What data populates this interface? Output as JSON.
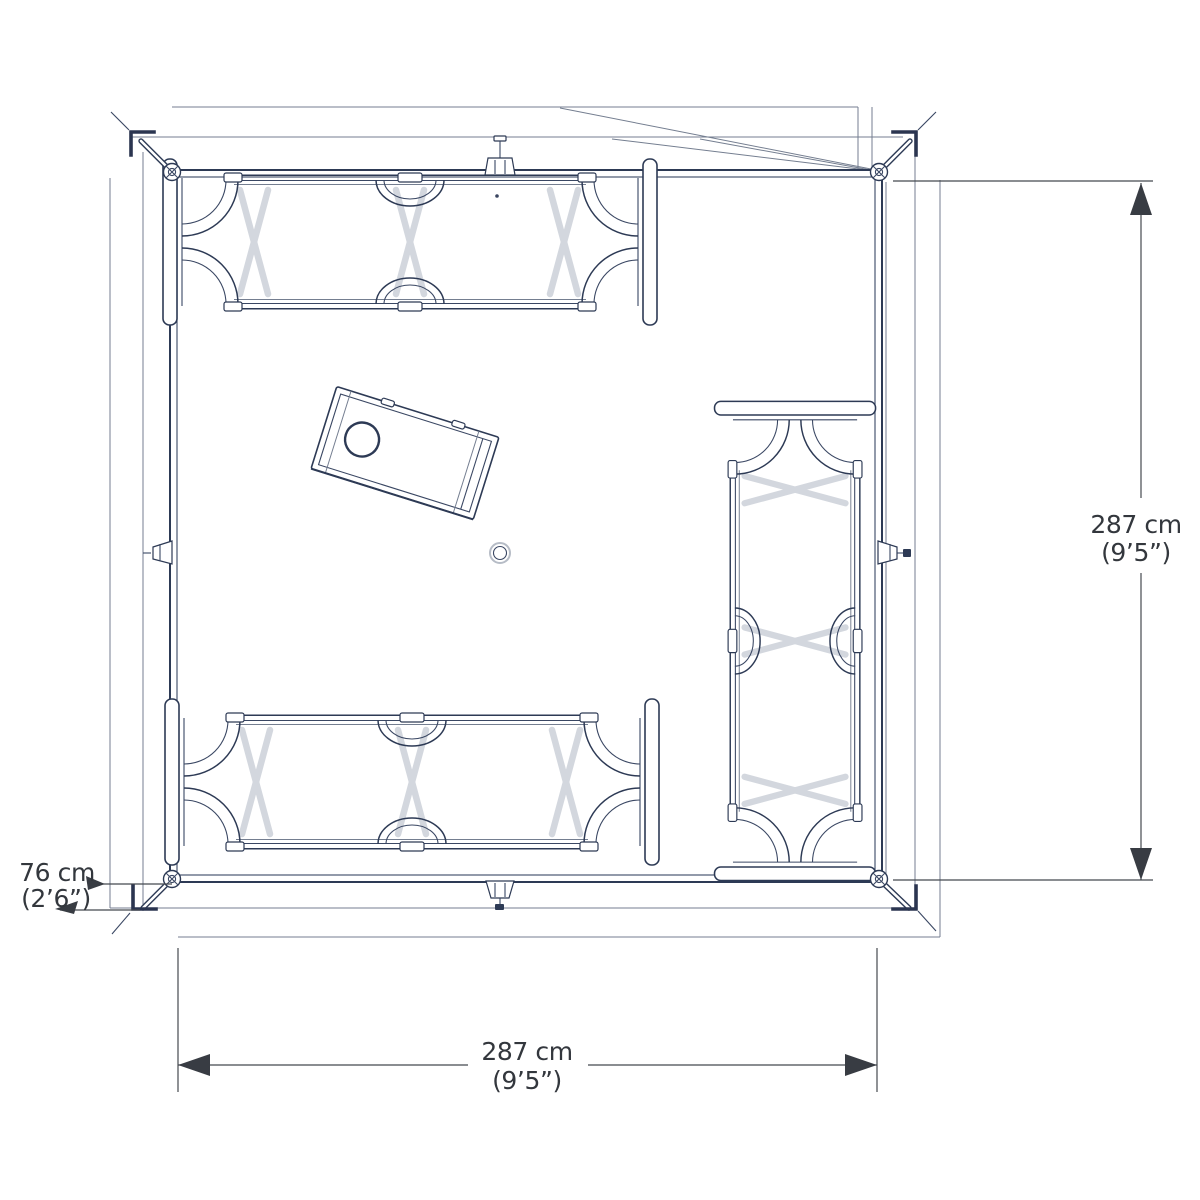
{
  "title": "Tent floor plan – top view technical drawing",
  "dimensions": {
    "depth_value": "287 cm",
    "depth_imperial": "(9’5”)",
    "width_value": "287 cm",
    "width_imperial": "(9’5”)",
    "porch_value": "76 cm",
    "porch_imperial": "(2’6”)"
  },
  "colors": {
    "line": "#2d3a55",
    "line_light": "#747e90",
    "cot_legs": "#d3d7de",
    "dimension_text": "#33373d",
    "background": "#ffffff"
  },
  "objects": {
    "cot_top": "folding camp cot",
    "cot_bottom": "folding camp cot",
    "cot_right": "folding camp cot",
    "table": "camp table with round hole",
    "center_marker": "centre pole base",
    "corner_joints": "corner hub with spreader strut",
    "wall_fixtures": "mid-wall pole fittings"
  }
}
